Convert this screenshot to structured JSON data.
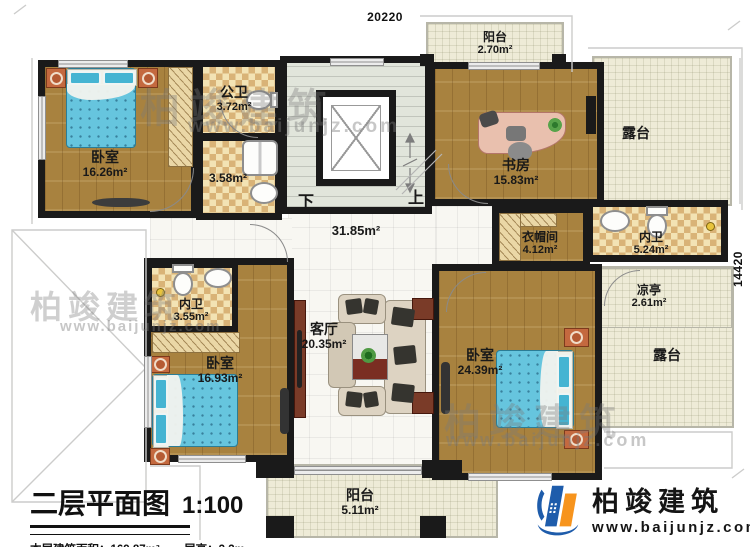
{
  "meta": {
    "dim_top": "20220",
    "dim_right": "14420"
  },
  "title_block": {
    "title": "二层平面图",
    "scale": "1:100",
    "area_label": "本层建筑面积：",
    "area_value": "169.87m²",
    "height_label": "层高：",
    "height_value": "3.3m"
  },
  "brand": {
    "name": "柏竣建筑",
    "url": "www.baijunjz.com"
  },
  "stairs": {
    "down": "下",
    "up": "上"
  },
  "rooms": {
    "bedroom_tl": {
      "name": "卧室",
      "area": "16.26m²"
    },
    "public_bath": {
      "name": "公卫",
      "area": "3.72m²"
    },
    "shower_room": {
      "area": "3.58m²"
    },
    "hall": {
      "area": "31.85m²"
    },
    "study": {
      "name": "书房",
      "area": "15.83m²"
    },
    "balcony_top": {
      "name": "阳台",
      "area": "2.70m²"
    },
    "terrace_top": {
      "name": "露台"
    },
    "cloakroom": {
      "name": "衣帽间",
      "area": "4.12m²"
    },
    "bath_right": {
      "name": "内卫",
      "area": "5.24m²"
    },
    "pavilion": {
      "name": "凉亭",
      "area": "2.61m²"
    },
    "terrace_right": {
      "name": "露台"
    },
    "bath_left": {
      "name": "内卫",
      "area": "3.55m²"
    },
    "bedroom_bl": {
      "name": "卧室",
      "area": "16.93m²"
    },
    "living": {
      "name": "客厅",
      "area": "20.35m²"
    },
    "bedroom_br": {
      "name": "卧室",
      "area": "24.39m²"
    },
    "balcony_bottom": {
      "name": "阳台",
      "area": "5.11m²"
    }
  },
  "colors": {
    "wall": "#1a1a1a",
    "wood": "#a8823f",
    "checker": "#d9b377",
    "terrace": "#eeebd7",
    "logo_blue": "#1e5cab",
    "logo_orange": "#f7941d"
  }
}
